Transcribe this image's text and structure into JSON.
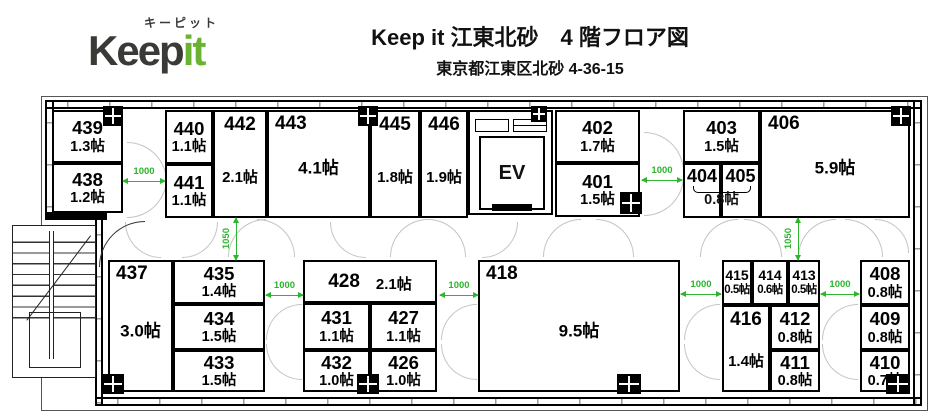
{
  "header": {
    "logo": {
      "katakana": "キーピット",
      "brand_dark": "Keep",
      "brand_green": "it"
    },
    "title": "Keep it 江東北砂　4 階フロア図",
    "subtitle": "東京都江東区北砂 4-36-15"
  },
  "colors": {
    "dimension_green": "#2db52d",
    "logo_green": "#6ab331",
    "wall_black": "#000000"
  },
  "plan": {
    "ev_label": "EV",
    "unit_suffix": "帖",
    "rooms": [
      {
        "id": "439",
        "size": "1.3帖",
        "x": 52,
        "y": 110,
        "w": 71,
        "h": 53,
        "layout": "stack"
      },
      {
        "id": "438",
        "size": "1.2帖",
        "x": 52,
        "y": 163,
        "w": 71,
        "h": 50,
        "layout": "stack"
      },
      {
        "id": "440",
        "size": "1.1帖",
        "x": 165,
        "y": 110,
        "w": 48,
        "h": 54,
        "layout": "stack"
      },
      {
        "id": "441",
        "size": "1.1帖",
        "x": 165,
        "y": 164,
        "w": 48,
        "h": 54,
        "layout": "stack"
      },
      {
        "id": "442",
        "size": "2.1帖",
        "x": 213,
        "y": 110,
        "w": 54,
        "h": 108,
        "layout": "tall"
      },
      {
        "id": "443",
        "size": "4.1帖",
        "x": 267,
        "y": 110,
        "w": 103,
        "h": 108,
        "layout": "corner"
      },
      {
        "id": "445",
        "size": "1.8帖",
        "x": 370,
        "y": 110,
        "w": 50,
        "h": 108,
        "layout": "tall"
      },
      {
        "id": "446",
        "size": "1.9帖",
        "x": 420,
        "y": 110,
        "w": 48,
        "h": 108,
        "layout": "tall"
      },
      {
        "id": "402",
        "size": "1.7帖",
        "x": 555,
        "y": 110,
        "w": 85,
        "h": 53,
        "layout": "stack"
      },
      {
        "id": "401",
        "size": "1.5帖",
        "x": 555,
        "y": 163,
        "w": 85,
        "h": 54,
        "layout": "stack"
      },
      {
        "id": "403",
        "size": "1.5帖",
        "x": 683,
        "y": 110,
        "w": 77,
        "h": 53,
        "layout": "stack"
      },
      {
        "id": "404",
        "size": "",
        "x": 683,
        "y": 163,
        "w": 38,
        "h": 55,
        "layout": "num"
      },
      {
        "id": "405",
        "size": "",
        "x": 721,
        "y": 163,
        "w": 39,
        "h": 55,
        "layout": "num"
      },
      {
        "id": "406",
        "size": "5.9帖",
        "x": 760,
        "y": 110,
        "w": 150,
        "h": 108,
        "layout": "corner"
      },
      {
        "id": "437",
        "size": "3.0帖",
        "x": 108,
        "y": 260,
        "w": 65,
        "h": 132,
        "layout": "corner"
      },
      {
        "id": "435",
        "size": "1.4帖",
        "x": 173,
        "y": 260,
        "w": 92,
        "h": 44,
        "layout": "stack"
      },
      {
        "id": "434",
        "size": "1.5帖",
        "x": 173,
        "y": 304,
        "w": 92,
        "h": 46,
        "layout": "stack"
      },
      {
        "id": "433",
        "size": "1.5帖",
        "x": 173,
        "y": 350,
        "w": 92,
        "h": 42,
        "layout": "stack"
      },
      {
        "id": "428",
        "size": "2.1帖",
        "x": 303,
        "y": 260,
        "w": 134,
        "h": 43,
        "layout": "row"
      },
      {
        "id": "431",
        "size": "1.1帖",
        "x": 303,
        "y": 303,
        "w": 67,
        "h": 47,
        "layout": "stack"
      },
      {
        "id": "427",
        "size": "1.1帖",
        "x": 370,
        "y": 303,
        "w": 67,
        "h": 47,
        "layout": "stack"
      },
      {
        "id": "432",
        "size": "1.0帖",
        "x": 303,
        "y": 350,
        "w": 67,
        "h": 42,
        "layout": "stack"
      },
      {
        "id": "426",
        "size": "1.0帖",
        "x": 370,
        "y": 350,
        "w": 67,
        "h": 42,
        "layout": "stack"
      },
      {
        "id": "418",
        "size": "9.5帖",
        "x": 478,
        "y": 260,
        "w": 202,
        "h": 132,
        "layout": "corner"
      },
      {
        "id": "415",
        "size": "0.5帖",
        "x": 722,
        "y": 260,
        "w": 30,
        "h": 45,
        "layout": "small"
      },
      {
        "id": "414",
        "size": "0.6帖",
        "x": 752,
        "y": 260,
        "w": 36,
        "h": 45,
        "layout": "small"
      },
      {
        "id": "413",
        "size": "0.5帖",
        "x": 788,
        "y": 260,
        "w": 32,
        "h": 45,
        "layout": "small"
      },
      {
        "id": "416",
        "size": "1.4帖",
        "x": 722,
        "y": 305,
        "w": 48,
        "h": 87,
        "layout": "tall"
      },
      {
        "id": "412",
        "size": "0.8帖",
        "x": 770,
        "y": 305,
        "w": 50,
        "h": 45,
        "layout": "stack"
      },
      {
        "id": "411",
        "size": "0.8帖",
        "x": 770,
        "y": 350,
        "w": 50,
        "h": 42,
        "layout": "stack"
      },
      {
        "id": "408",
        "size": "0.8帖",
        "x": 860,
        "y": 260,
        "w": 50,
        "h": 45,
        "layout": "stack"
      },
      {
        "id": "409",
        "size": "0.8帖",
        "x": 860,
        "y": 305,
        "w": 50,
        "h": 45,
        "layout": "stack"
      },
      {
        "id": "410",
        "size": "0.7帖",
        "x": 860,
        "y": 350,
        "w": 50,
        "h": 42,
        "layout": "stack"
      }
    ],
    "shared_size": {
      "label": "0.8帖",
      "rooms": "404 405",
      "x": 683,
      "y": 186,
      "w": 77
    },
    "dimensions": [
      {
        "label": "1000",
        "dir": "h",
        "x": 123,
        "y": 167,
        "len": 42
      },
      {
        "label": "1050",
        "dir": "v",
        "x": 222,
        "y": 218,
        "len": 42
      },
      {
        "label": "1000",
        "dir": "h",
        "x": 266,
        "y": 281,
        "len": 37
      },
      {
        "label": "1000",
        "dir": "h",
        "x": 440,
        "y": 281,
        "len": 38
      },
      {
        "label": "1000",
        "dir": "h",
        "x": 642,
        "y": 166,
        "len": 40
      },
      {
        "label": "1050",
        "dir": "v",
        "x": 784,
        "y": 218,
        "len": 42
      },
      {
        "label": "1000",
        "dir": "h",
        "x": 681,
        "y": 280,
        "len": 40
      },
      {
        "label": "1000",
        "dir": "h",
        "x": 821,
        "y": 280,
        "len": 38
      }
    ]
  }
}
